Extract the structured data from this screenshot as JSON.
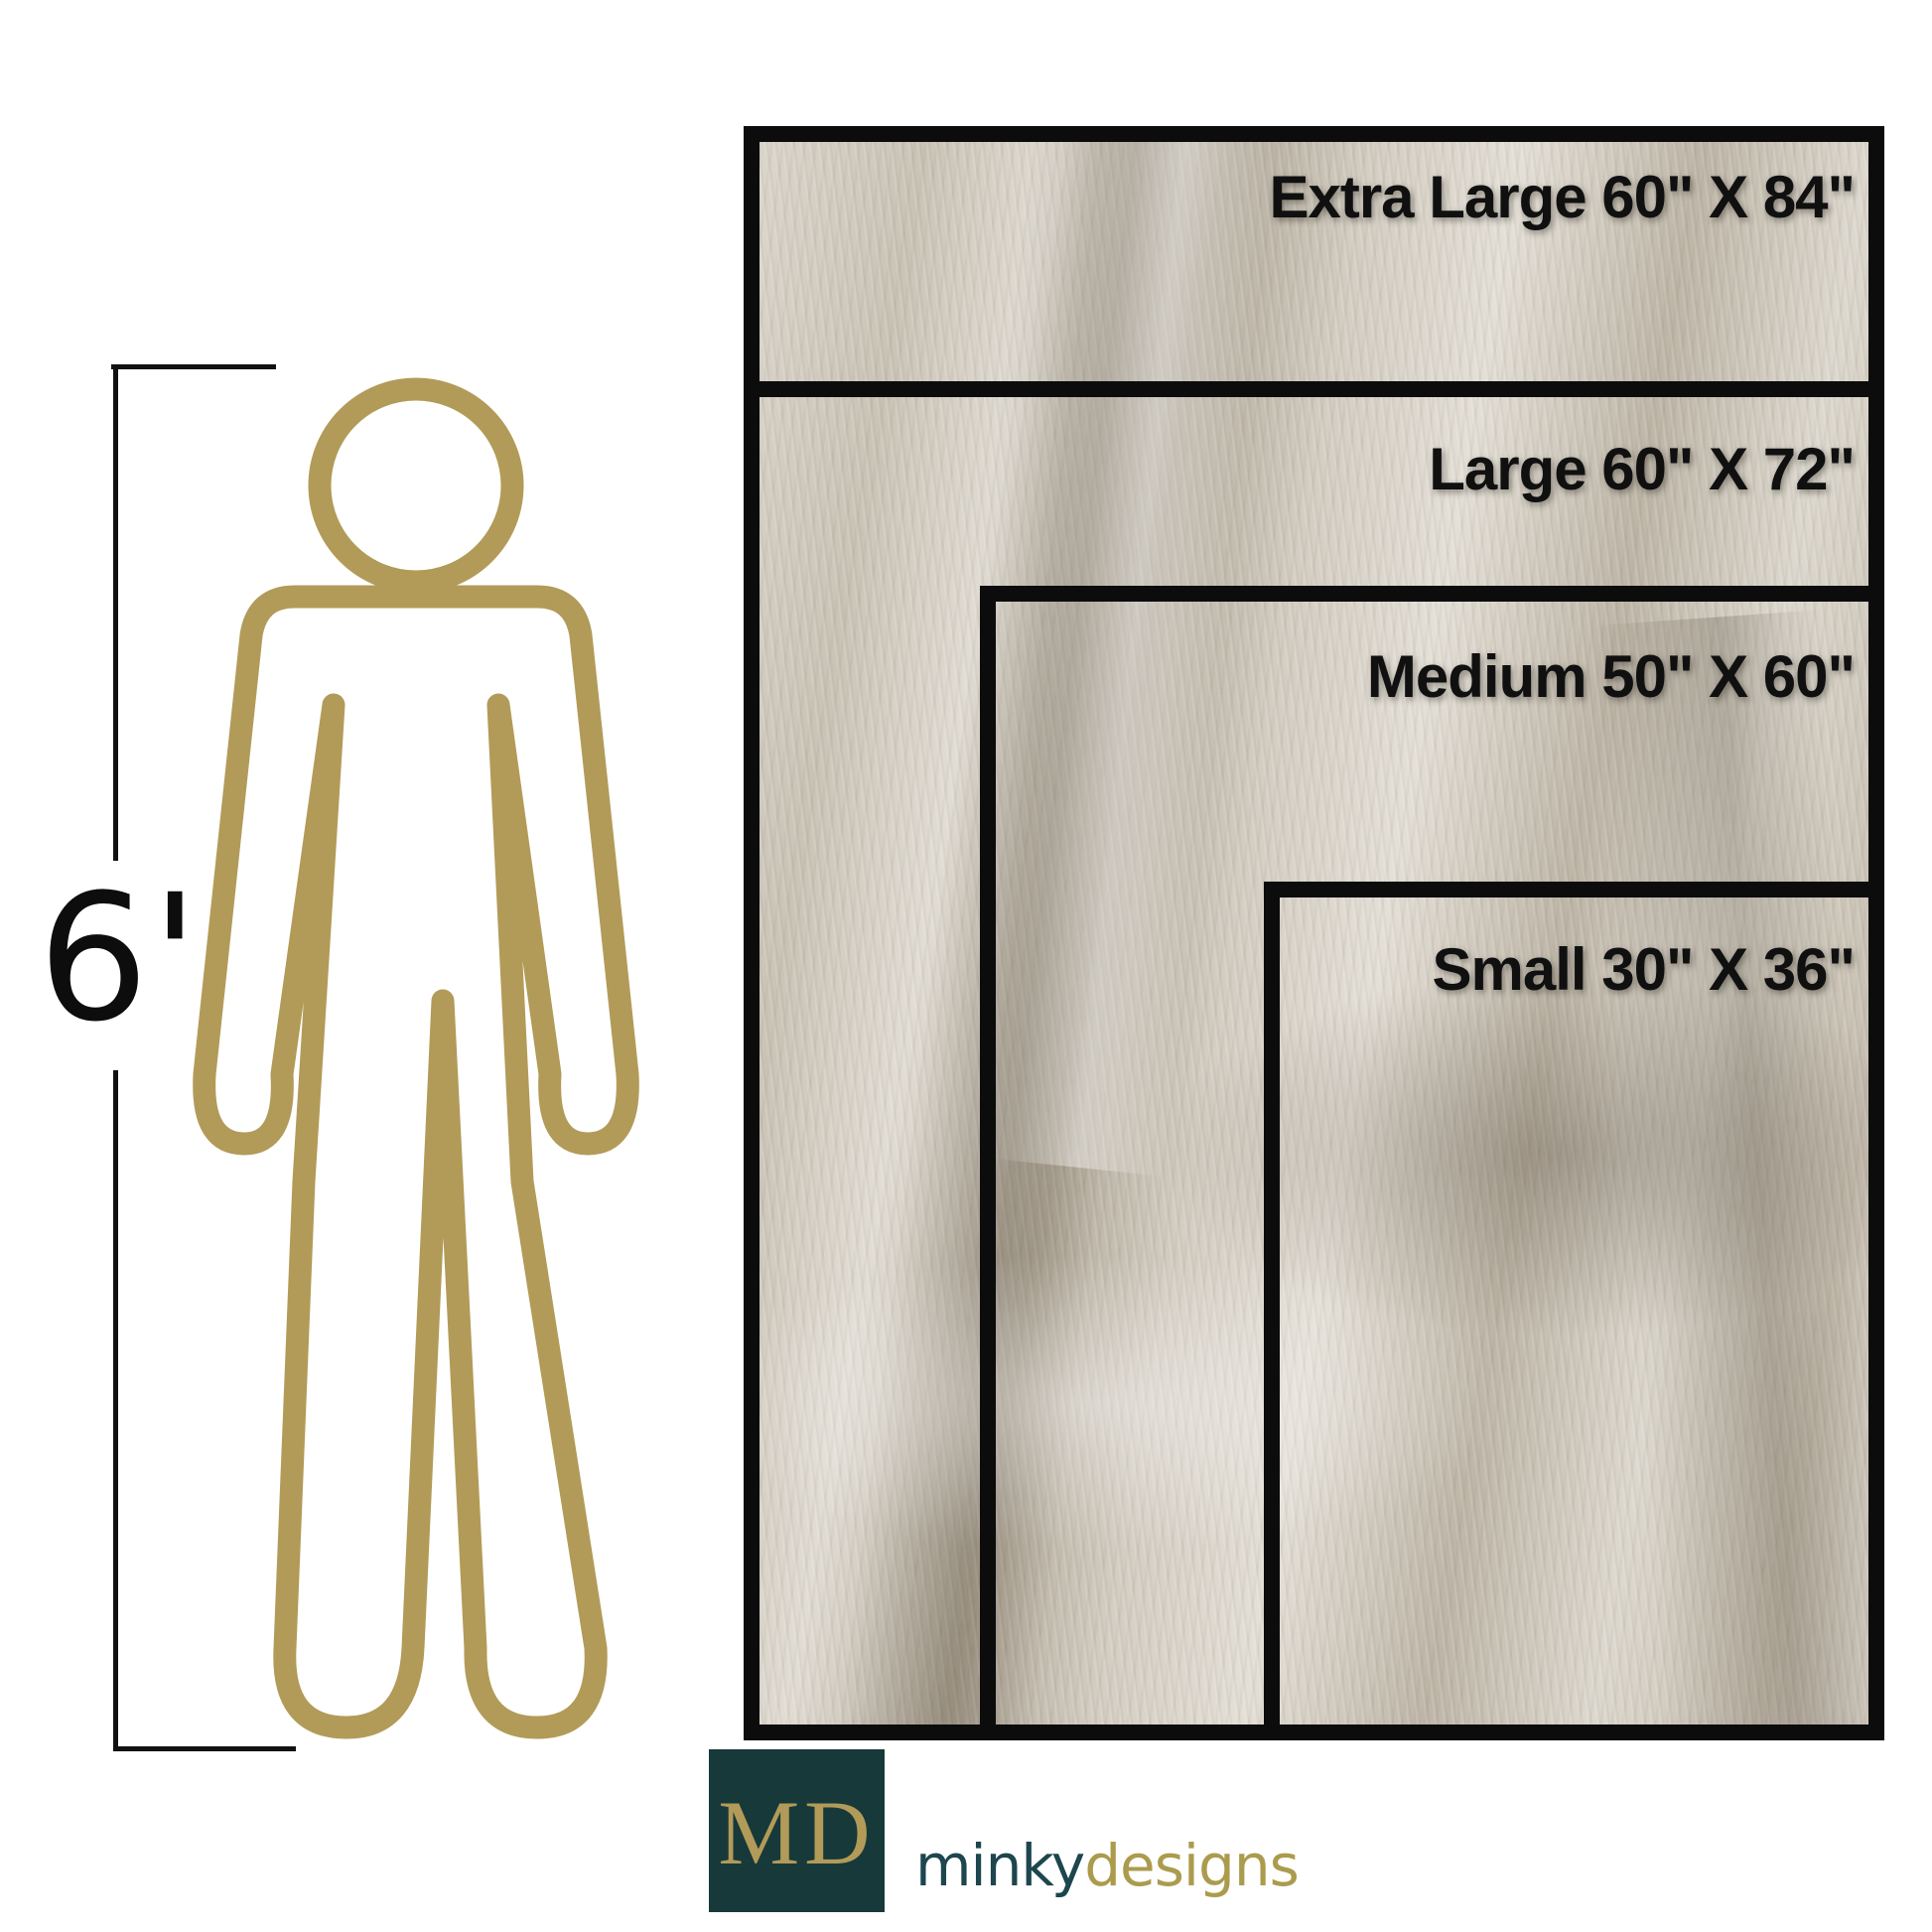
{
  "colors": {
    "bg": "#ffffff",
    "line": "#111111",
    "border": "#0c0c0c",
    "label": "#101010",
    "gold": "#b29b58",
    "gold-text": "#ab9b4d",
    "teal": "#17393a",
    "teal-text": "#1d464e",
    "fabric-base": "#c9c2b7"
  },
  "height_marker": {
    "label": "6'"
  },
  "size_chart": {
    "unit": "inches",
    "sizes": [
      {
        "name": "Extra Large",
        "width_in": 60,
        "height_in": 84,
        "label": "Extra Large 60\" X 84\""
      },
      {
        "name": "Large",
        "width_in": 60,
        "height_in": 72,
        "label": "Large 60\" X 72\""
      },
      {
        "name": "Medium",
        "width_in": 50,
        "height_in": 60,
        "label": "Medium 50\" X 60\""
      },
      {
        "name": "Small",
        "width_in": 30,
        "height_in": 36,
        "label": "Small 30\" X 36\""
      }
    ]
  },
  "footer": {
    "monogram": "MD",
    "brand": {
      "first": "minky",
      "second": "designs"
    }
  }
}
